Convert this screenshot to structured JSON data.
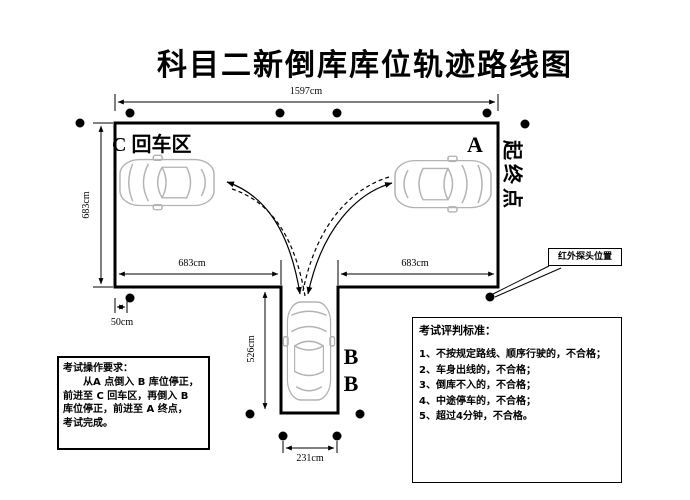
{
  "title": "科目二新倒库库位轨迹路线图",
  "course": {
    "zone_c_label": "C 回车区",
    "point_a_label": "A",
    "point_b_label_1": "B",
    "point_b_label_2": "B",
    "start_end_label": "起终点",
    "sensor_label": "红外探头位置"
  },
  "dimensions": {
    "top_width": "1597cm",
    "left_height": "683cm",
    "bottom_left_width": "683cm",
    "bottom_right_width": "683cm",
    "bay_depth": "526cm",
    "sensor_offset": "50cm",
    "bay_width": "231cm"
  },
  "operation_box": {
    "title": "考试操作要求：",
    "lines": [
      "　　从A 点倒入 B 库位停正，",
      "前进至 C 回车区，再倒入 B",
      "库位停正，前进至 A 终点，",
      "考试完成。"
    ]
  },
  "judging_box": {
    "title": "考试评判标准：",
    "items": [
      "1、不按规定路线、顺序行驶的，不合格；",
      "2、车身出线的，不合格；",
      "3、倒库不入的，不合格；",
      "4、中途停车的，不合格；",
      "5、超过4分钟，不合格。"
    ]
  },
  "colors": {
    "line": "#000000",
    "car_outline": "#b3b3b3",
    "background": "#ffffff"
  }
}
